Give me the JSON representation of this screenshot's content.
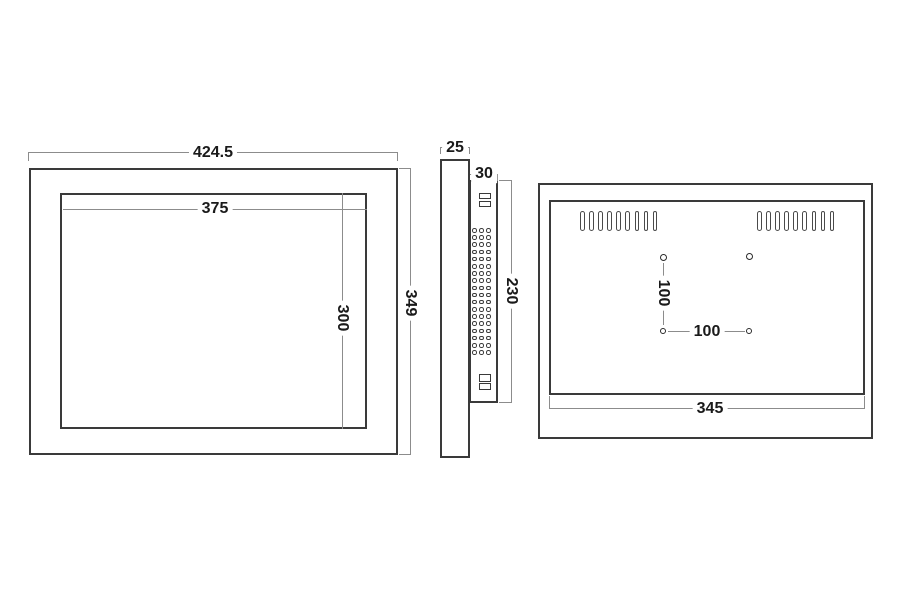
{
  "front_view": {
    "overall_width": "424.5",
    "overall_height": "349",
    "display_width": "375",
    "display_height": "300"
  },
  "side_view": {
    "front_thickness": "25",
    "rear_thickness": "30",
    "rear_height": "230",
    "vent_hole_grid": {
      "rows": 18,
      "cols": 3
    },
    "top_connector_blocks": 2,
    "bottom_connector_blocks": 2
  },
  "back_view": {
    "body_width": "345",
    "vesa_vertical": "100",
    "vesa_horizontal": "100",
    "vent_slots_left": 9,
    "vent_slots_right": 9,
    "mount_hole_count": 4
  },
  "colors": {
    "outline": "#3a3a3a",
    "detail": "#4a4a4a",
    "dimension_line": "#8c8c8c",
    "text": "#1a1a1a",
    "background": "#ffffff"
  }
}
